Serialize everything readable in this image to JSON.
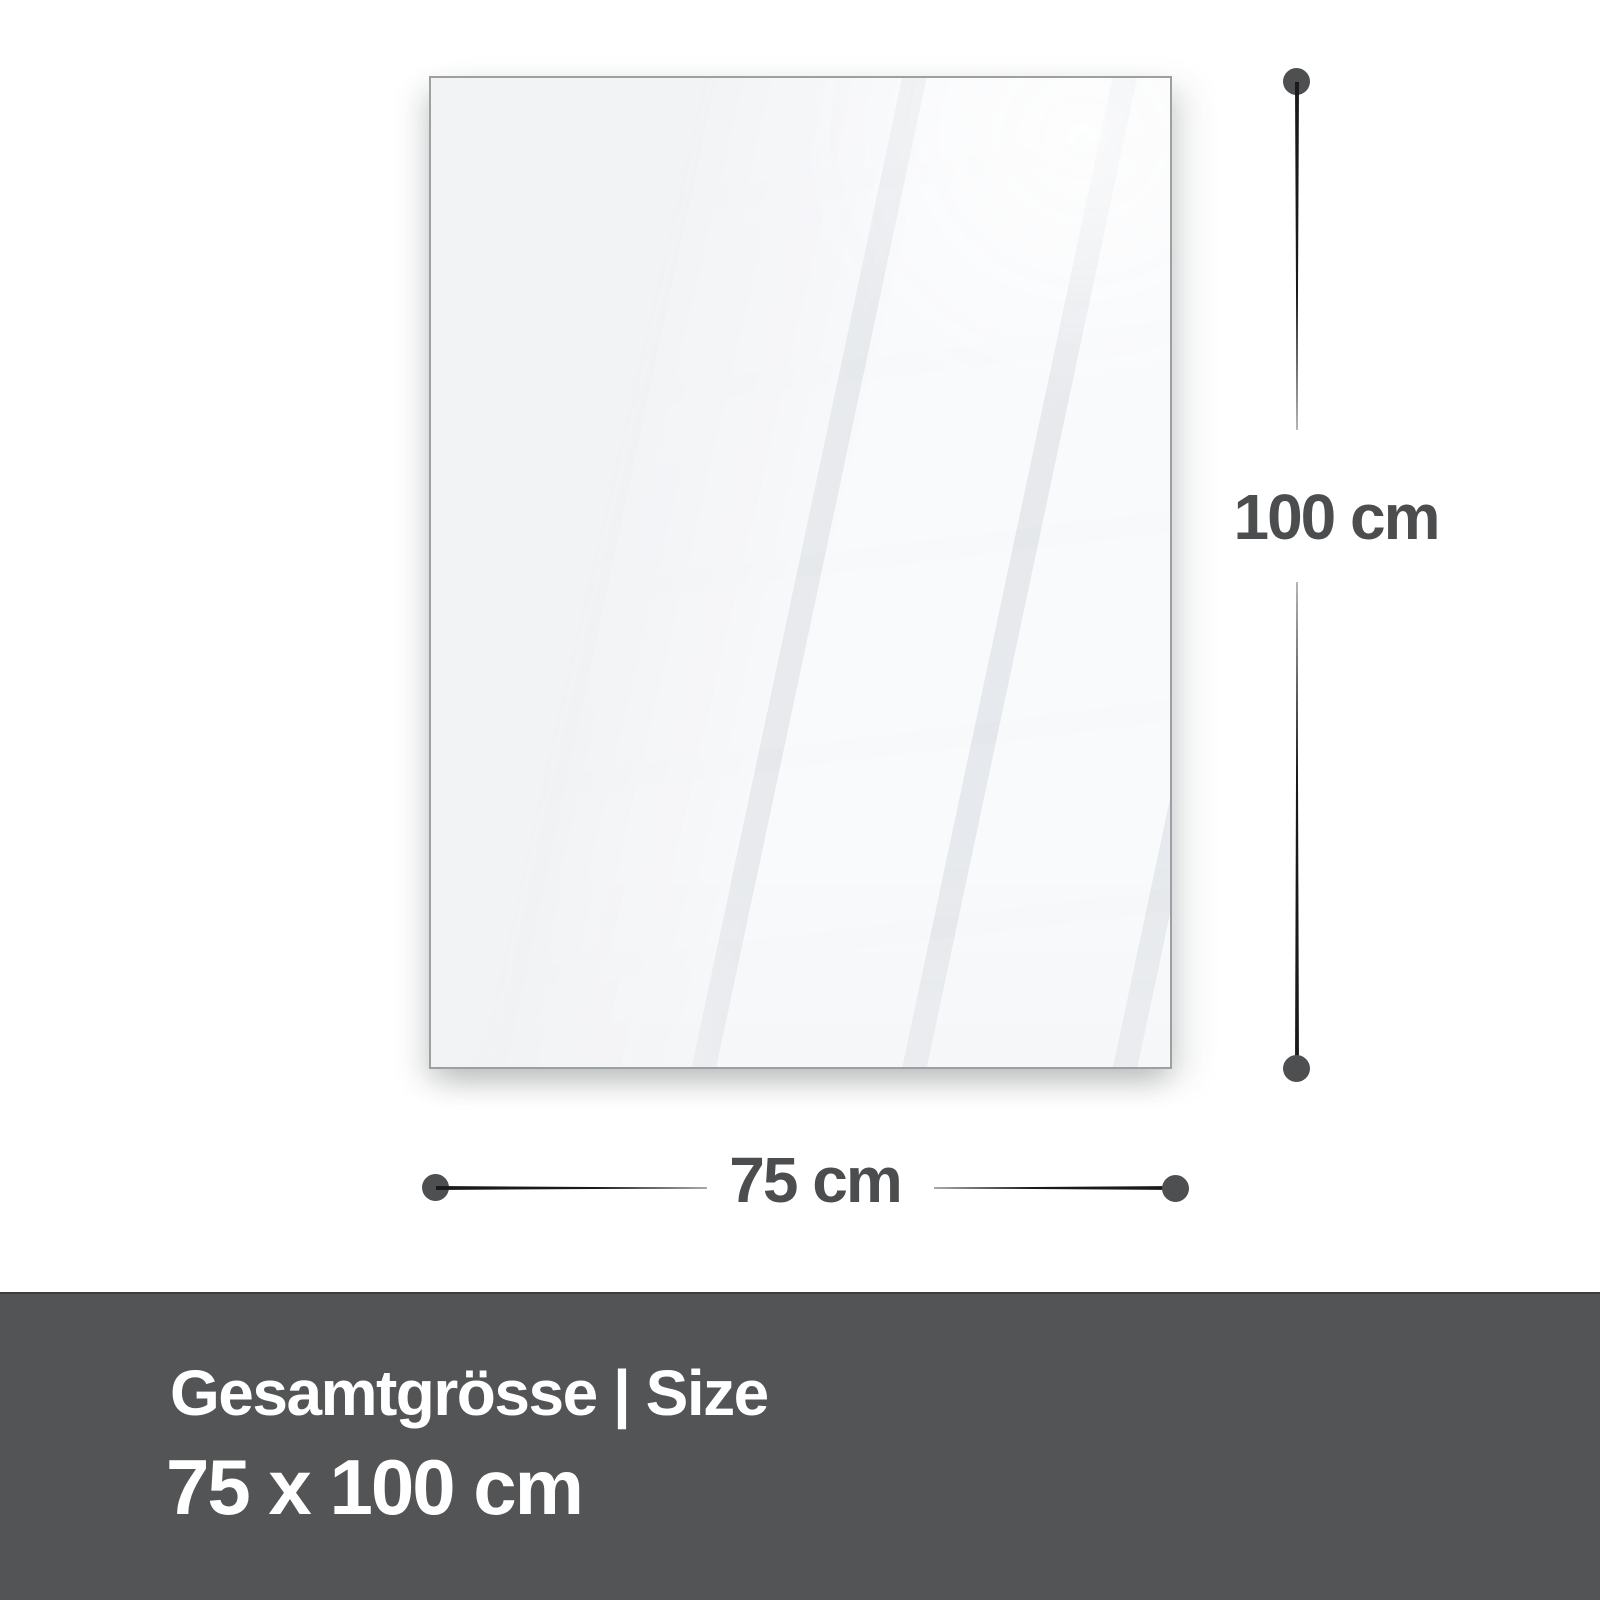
{
  "dimension_labels": {
    "height": "100 cm",
    "width": "75 cm"
  },
  "footer": {
    "title": "Gesamtgrösse | Size",
    "size": "75 x 100 cm"
  },
  "colors": {
    "page_background": "#ffffff",
    "panel_fill": "#f2f3f5",
    "panel_border": "#9da0a3",
    "dimension_line": "#1a1a1b",
    "dimension_dot": "#4d4f51",
    "dimension_text": "#4b4d4e",
    "footer_background": "#535456",
    "footer_text": "#ffffff"
  }
}
